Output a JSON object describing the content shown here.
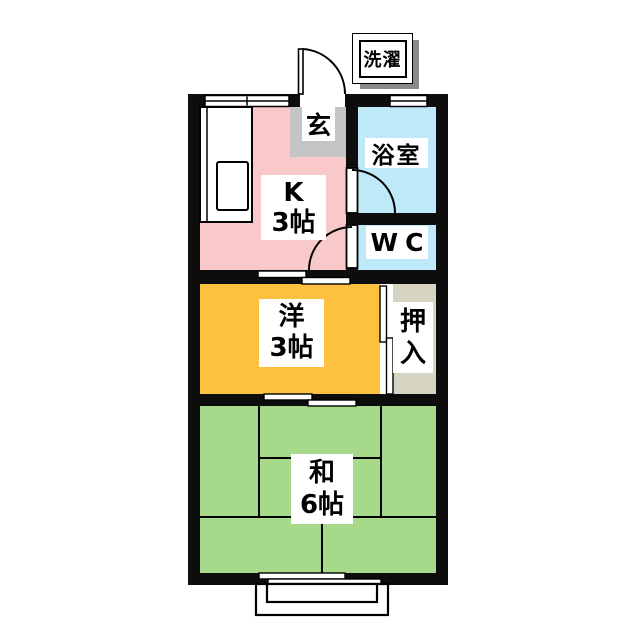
{
  "plan_type": "apartment-floor-plan",
  "rooms": {
    "kitchen": {
      "label_line1": "K",
      "label_line2": "3帖",
      "color": "#f9c9ca"
    },
    "bathroom": {
      "label": "浴室",
      "color": "#bfe8f9"
    },
    "wc": {
      "label": "WC",
      "color": "#bfe8f9"
    },
    "western": {
      "label_line1": "洋",
      "label_line2": "3帖",
      "color": "#fcc23f"
    },
    "closet": {
      "label_line1": "押",
      "label_line2": "入",
      "color": "#d8d4c4"
    },
    "japanese": {
      "label_line1": "和",
      "label_line2": "6帖",
      "color": "#a6da8a"
    },
    "entrance_hall": {
      "label": "玄",
      "color": "#c4c4c4"
    },
    "laundry": {
      "label": "洗濯"
    }
  },
  "colors": {
    "wall": "#0d0d0d",
    "label_background": "#ffffff",
    "laundry_shadow": "#8a8a8a",
    "background": "#ffffff"
  }
}
